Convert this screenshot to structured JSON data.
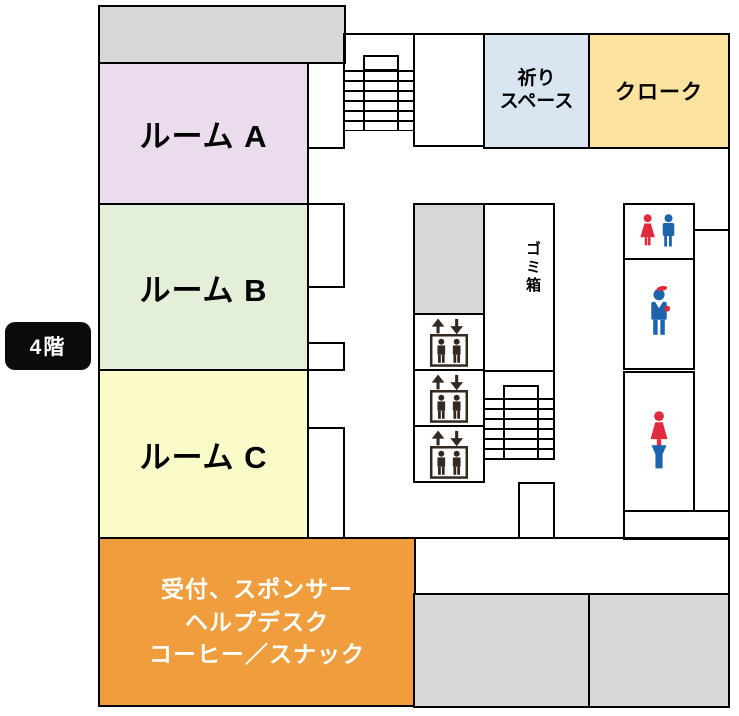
{
  "floor_badge": {
    "label": "4階",
    "bg_color": "#0b0b0b",
    "text_color": "#ffffff"
  },
  "rooms": {
    "room_a": {
      "label": "ルーム A",
      "color": "#eadcec"
    },
    "room_b": {
      "label": "ルーム B",
      "color": "#e3efd8"
    },
    "room_c": {
      "label": "ルーム C",
      "color": "#fbfbc9"
    },
    "prayer_space": {
      "label_line1": "祈り",
      "label_line2": "スペース",
      "color": "#d9e6f2"
    },
    "cloak": {
      "label": "クローク",
      "color": "#fce3a0"
    },
    "reception": {
      "label_line1": "受付、スポンサー",
      "label_line2": "ヘルプデスク",
      "label_line3": "コーヒー／スナック",
      "color": "#f09d3d",
      "text_color": "#ffffff"
    }
  },
  "facilities": {
    "trash_box": {
      "label": "ゴミ箱"
    },
    "elevators": {
      "icon": "elevator-icon",
      "count": 3
    },
    "restrooms": {
      "top": {
        "icon": "restroom-men-women-icon"
      },
      "middle": {
        "icon": "restroom-men-icon"
      },
      "bottom": {
        "icon": "restroom-women-icon"
      }
    },
    "stairs": {
      "count": 2
    }
  },
  "colors": {
    "wall": "#000000",
    "gray_area": "#d7d7d7",
    "icon_red": "#e02a3d",
    "icon_blue": "#1c64ae",
    "elevator_icon": "#33291f"
  }
}
